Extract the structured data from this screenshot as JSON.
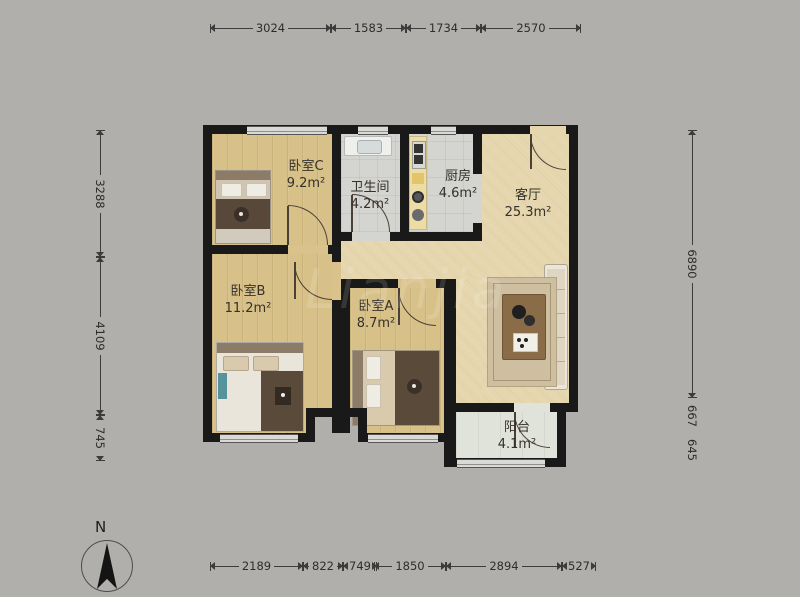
{
  "compass": {
    "label": "N"
  },
  "watermark": "Lianjia",
  "rooms": [
    {
      "id": "bedroom-c",
      "name": "卧室C",
      "area": "9.2m²",
      "x": 212,
      "y": 134,
      "w": 120,
      "h": 111,
      "floor": "wood",
      "label_cx": 306,
      "label_cy": 176
    },
    {
      "id": "bathroom",
      "name": "卫生间",
      "area": "4.2m²",
      "x": 341,
      "y": 134,
      "w": 59,
      "h": 98,
      "floor": "tile",
      "label_cx": 370,
      "label_cy": 197
    },
    {
      "id": "kitchen",
      "name": "厨房",
      "area": "4.6m²",
      "x": 409,
      "y": 134,
      "w": 64,
      "h": 98,
      "floor": "tile",
      "label_cx": 458,
      "label_cy": 186
    },
    {
      "id": "living-room",
      "name": "客厅",
      "area": "25.3m²",
      "x": 482,
      "y": 134,
      "w": 87,
      "h": 269,
      "floor": "plaster",
      "label_cx": 528,
      "label_cy": 205
    },
    {
      "id": "hallway",
      "name": "",
      "area": "",
      "x": 341,
      "y": 241,
      "w": 141,
      "h": 38,
      "floor": "plaster"
    },
    {
      "id": "hallway-ext",
      "name": "",
      "area": "",
      "x": 456,
      "y": 279,
      "w": 26,
      "h": 124,
      "floor": "plaster"
    },
    {
      "id": "bedroom-b",
      "name": "卧室B",
      "area": "11.2m²",
      "x": 212,
      "y": 254,
      "w": 120,
      "h": 179,
      "floor": "wood",
      "label_cx": 248,
      "label_cy": 301
    },
    {
      "id": "bedroom-a",
      "name": "卧室A",
      "area": "8.7m²",
      "x": 350,
      "y": 288,
      "w": 94,
      "h": 145,
      "floor": "wood",
      "label_cx": 376,
      "label_cy": 316
    },
    {
      "id": "balcony",
      "name": "阳台",
      "area": "4.1m²",
      "x": 456,
      "y": 412,
      "w": 101,
      "h": 46,
      "floor": "balconyf",
      "label_cx": 517,
      "label_cy": 437
    }
  ],
  "cutouts": [
    [
      315,
      417,
      43,
      30
    ]
  ],
  "walls": [
    [
      203,
      125,
      375,
      9
    ],
    [
      203,
      125,
      9,
      317
    ],
    [
      569,
      125,
      9,
      287
    ],
    [
      332,
      134,
      9,
      120
    ],
    [
      400,
      134,
      9,
      98
    ],
    [
      473,
      134,
      9,
      40
    ],
    [
      473,
      223,
      9,
      18
    ],
    [
      332,
      232,
      150,
      9
    ],
    [
      203,
      245,
      138,
      9
    ],
    [
      332,
      245,
      9,
      188
    ],
    [
      341,
      279,
      115,
      9
    ],
    [
      341,
      279,
      9,
      154
    ],
    [
      444,
      279,
      12,
      163
    ],
    [
      203,
      433,
      112,
      9
    ],
    [
      306,
      408,
      61,
      9
    ],
    [
      306,
      408,
      9,
      34
    ],
    [
      358,
      408,
      9,
      34
    ],
    [
      358,
      433,
      98,
      9
    ],
    [
      444,
      403,
      122,
      9
    ],
    [
      444,
      403,
      12,
      64
    ],
    [
      557,
      403,
      9,
      64
    ],
    [
      557,
      403,
      21,
      9
    ],
    [
      444,
      458,
      122,
      9
    ]
  ],
  "windows": [
    [
      247,
      126,
      80,
      7
    ],
    [
      358,
      126,
      30,
      7
    ],
    [
      431,
      126,
      25,
      7
    ],
    [
      220,
      434,
      78,
      7
    ],
    [
      368,
      434,
      70,
      7
    ],
    [
      457,
      459,
      88,
      7
    ]
  ],
  "door_gaps": [
    [
      288,
      245,
      40,
      9,
      "#d9c28b"
    ],
    [
      352,
      232,
      38,
      9,
      "#d4d4d1"
    ],
    [
      530,
      126,
      36,
      8,
      "#e5d6ae"
    ],
    [
      332,
      262,
      9,
      38,
      "#d9c28b"
    ],
    [
      398,
      279,
      38,
      9,
      "#d9c28b"
    ],
    [
      514,
      403,
      36,
      9,
      "#e0e3da"
    ],
    [
      473,
      174,
      9,
      49,
      "#d4d4d1"
    ]
  ],
  "doors": [
    {
      "name": "bedroom-c-door",
      "x": 288,
      "y": 205,
      "w": 40,
      "h": 40,
      "corner": "tr",
      "leaf": "left"
    },
    {
      "name": "bathroom-door",
      "x": 352,
      "y": 194,
      "w": 38,
      "h": 38,
      "corner": "tr",
      "leaf": "left"
    },
    {
      "name": "entrance-door",
      "x": 530,
      "y": 134,
      "w": 36,
      "h": 36,
      "corner": "bl",
      "leaf": "left"
    },
    {
      "name": "bedroom-b-door",
      "x": 294,
      "y": 262,
      "w": 38,
      "h": 38,
      "corner": "bl",
      "leaf": "left"
    },
    {
      "name": "bedroom-a-door",
      "x": 398,
      "y": 288,
      "w": 38,
      "h": 38,
      "corner": "bl",
      "leaf": "left"
    },
    {
      "name": "balcony-door",
      "x": 514,
      "y": 412,
      "w": 36,
      "h": 36,
      "corner": "bl",
      "leaf": "left"
    }
  ],
  "dimensions": {
    "top": {
      "y": 28,
      "segments": [
        {
          "label": "3024",
          "a": 210,
          "b": 331
        },
        {
          "label": "1583",
          "a": 331,
          "b": 406
        },
        {
          "label": "1734",
          "a": 406,
          "b": 481
        },
        {
          "label": "2570",
          "a": 481,
          "b": 581
        }
      ]
    },
    "bottom": {
      "y": 566,
      "segments": [
        {
          "label": "2189",
          "a": 210,
          "b": 303
        },
        {
          "label": "822",
          "a": 303,
          "b": 343
        },
        {
          "label": "749",
          "a": 343,
          "b": 374
        },
        {
          "label": "1850",
          "a": 374,
          "b": 446
        },
        {
          "label": "2894",
          "a": 446,
          "b": 562
        },
        {
          "label": "527",
          "a": 562,
          "b": 588
        }
      ]
    },
    "left": {
      "x": 100,
      "segments": [
        {
          "label": "3288",
          "a": 130,
          "b": 257
        },
        {
          "label": "4109",
          "a": 257,
          "b": 415
        },
        {
          "label": "745",
          "a": 415,
          "b": 461
        }
      ]
    },
    "right": {
      "x": 692,
      "segments": [
        {
          "label": "6890",
          "a": 130,
          "b": 398
        },
        {
          "label": "667",
          "a": 398,
          "b": 433,
          "plain": true
        },
        {
          "label": "645",
          "a": 433,
          "b": 466,
          "plain": true
        }
      ]
    }
  }
}
